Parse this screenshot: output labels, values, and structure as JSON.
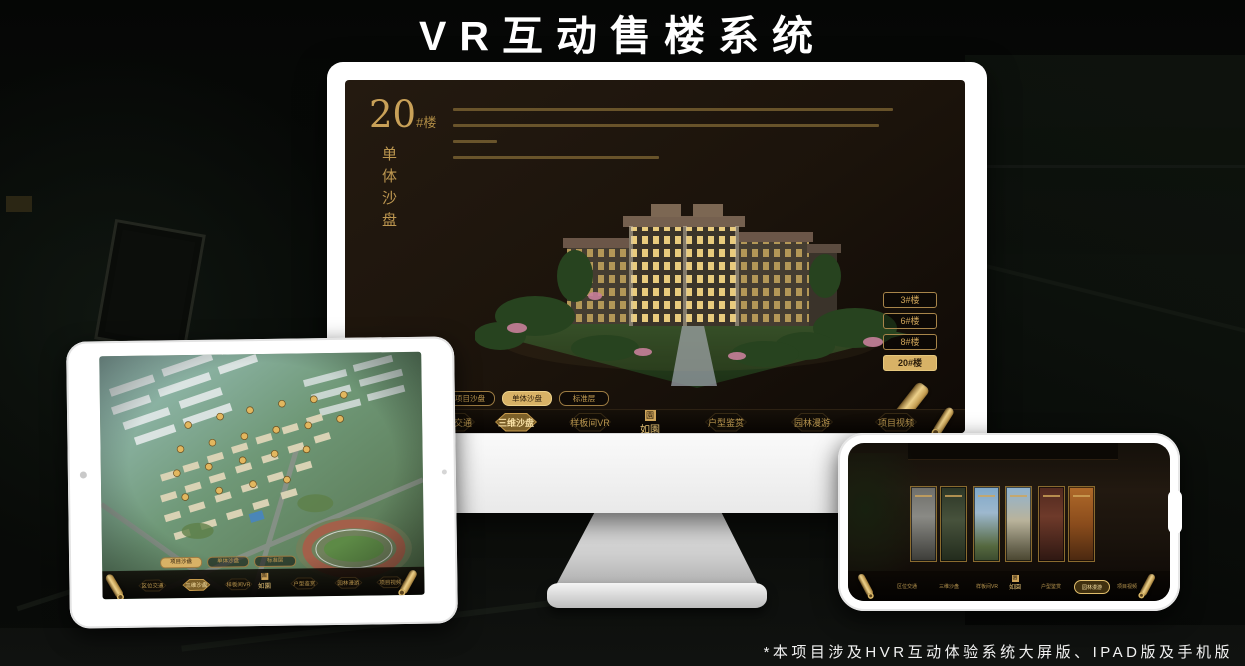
{
  "page": {
    "title": "VR互动售楼系统",
    "footnote": "*本项目涉及HVR互动体验系统大屏版、IPAD版及手机版"
  },
  "colors": {
    "gold": "#CFA55A",
    "gold_active_fill": "#D8B266",
    "screen_background": "#1B130B",
    "page_background": "#070907"
  },
  "app": {
    "headline": {
      "number": "20",
      "suffix": "#楼",
      "subtitle": "单体沙盘"
    },
    "floor_buttons": [
      "3#楼",
      "6#楼",
      "8#楼",
      "20#楼"
    ],
    "subtabs": [
      "项目沙盘",
      "单体沙盘",
      "标准层"
    ],
    "nav_items": [
      "区位交通",
      "三维沙盘",
      "样板间VR",
      "户型鉴赏",
      "园林漫游",
      "项目视频"
    ],
    "logo": "如園",
    "logo_seal": "園"
  }
}
